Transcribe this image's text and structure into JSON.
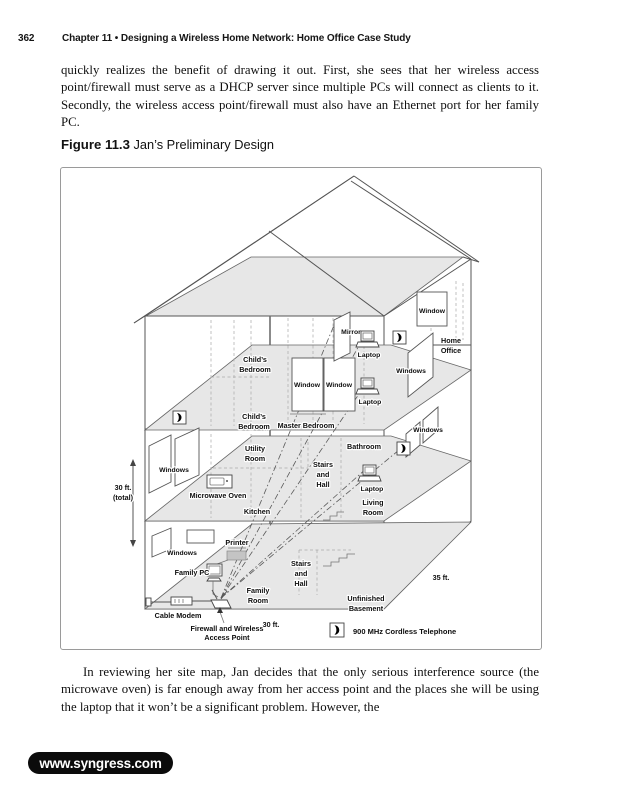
{
  "page": {
    "number": "362",
    "chapter_header": "Chapter 11 • Designing a Wireless Home Network: Home Office Case Study"
  },
  "paragraph_top": "quickly realizes the benefit of drawing it out. First, she sees that her wireless access point/firewall must serve as a DHCP server since multiple PCs will connect as clients to it. Secondly, the wireless access point/firewall must also have an Ethernet port for her family PC.",
  "figure": {
    "label": "Figure 11.3",
    "title": " Jan’s Preliminary Design"
  },
  "diagram": {
    "labels": {
      "childs_a1": "Child’s",
      "childs_a2": "Bedroom",
      "childs_b1": "Child’s",
      "childs_b2": "Bedroom",
      "master": "Master Bedroom",
      "mirror": "Mirror",
      "laptop_1": "Laptop",
      "laptop_2": "Laptop",
      "laptop_3": "Laptop",
      "window_attic": "Window",
      "window_mb_1": "Window",
      "window_mb_2": "Window",
      "windows_right_upper": "Windows",
      "windows_right_mid": "Windows",
      "windows_left_main": "Windows",
      "windows_left_basement": "Windows",
      "home_office_1": "Home",
      "home_office_2": "Office",
      "utility_1": "Utility",
      "utility_2": "Room",
      "bathroom": "Bathroom",
      "stairs_main_1": "Stairs",
      "stairs_main_2": "and",
      "stairs_main_3": "Hall",
      "microwave": "Microwave Oven",
      "kitchen": "Kitchen",
      "living_1": "Living",
      "living_2": "Room",
      "height_dim_1": "30 ft.",
      "height_dim_2": "(total)",
      "printer": "Printer",
      "family_pc": "Family PC",
      "family_room_1": "Family",
      "family_room_2": "Room",
      "stairs_bsmt_1": "Stairs",
      "stairs_bsmt_2": "and",
      "stairs_bsmt_3": "Hall",
      "unfinished_1": "Unfinished",
      "unfinished_2": "Basement",
      "cable_modem": "Cable Modem",
      "ap_1": "Firewall and Wireless",
      "ap_2": "Access Point",
      "width_dim": "30 ft.",
      "depth_dim": "35 ft.",
      "legend_phone": "900 MHz Cordless Telephone"
    },
    "colors": {
      "floor_fill": "#e7e7e7",
      "line": "#555555",
      "label_text": "#0e0e0e"
    }
  },
  "paragraph_bottom": "In reviewing her site map, Jan decides that the only serious interference source (the microwave oven) is far enough away from her access point and the places she will be using the laptop that it won’t be a significant problem. However, the",
  "footer": {
    "url": "www.syngress.com"
  }
}
